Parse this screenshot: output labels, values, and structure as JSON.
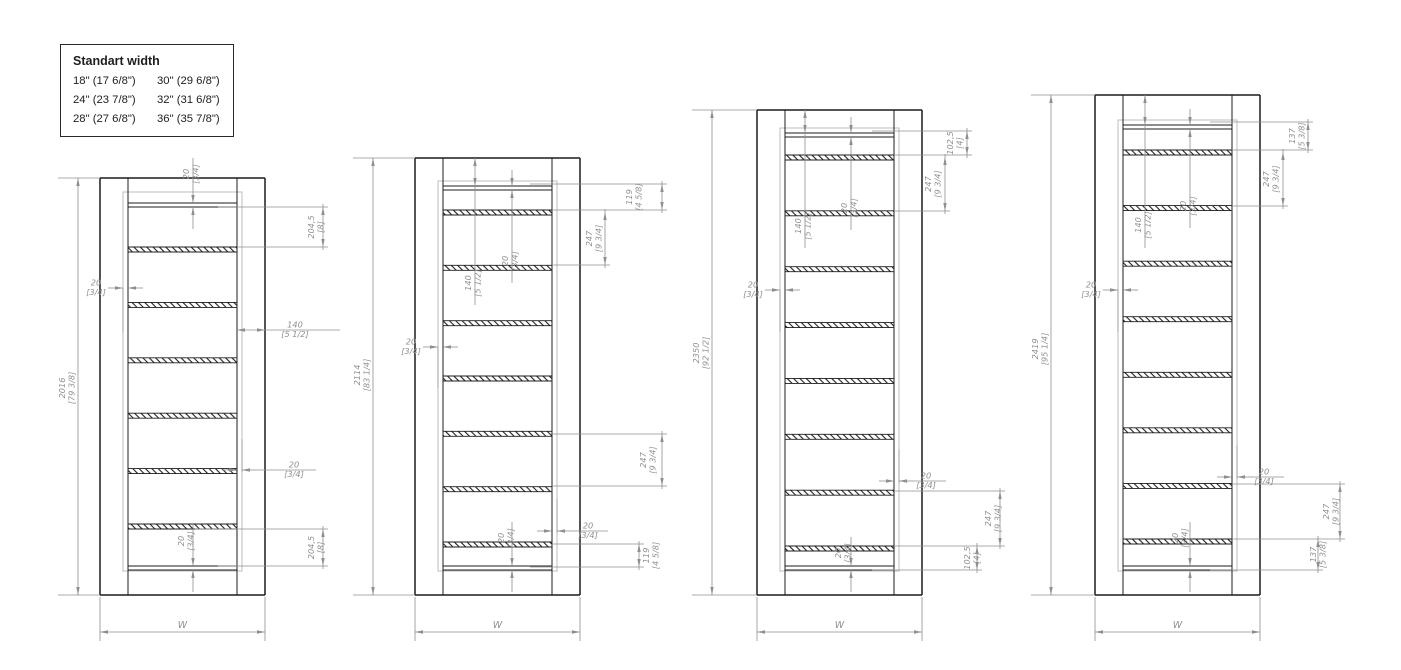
{
  "legend": {
    "title": "Standart width",
    "items": [
      "18\" (17 6/8\")",
      "30\" (29 6/8\")",
      "24\" (23 7/8\")",
      "32\" (31 6/8\")",
      "28\" (27 6/8\")",
      "36\" (35 7/8\")"
    ]
  },
  "styles": {
    "line_color": "#1c1c1c",
    "dim_color": "#8f8f8f",
    "leaf_color": "#bcbcbc",
    "bg": "#ffffff"
  },
  "shared": {
    "width_label": "W",
    "frame_w": 165,
    "jamb_w": 28,
    "bottom_y": 595,
    "bottom_rail_y": 566,
    "leaf_bottom_y": 571,
    "wdim_y": 632,
    "rail_t": 4,
    "shelf_t": 5,
    "leaf_off": 5
  },
  "drawings": [
    {
      "x0": 100,
      "top_y": 178,
      "dim_x": 78,
      "overall_label_y": 388,
      "height_mm": "2016",
      "height_in": "[79 3/8]",
      "rail_y": 203,
      "leaf_top": 192,
      "shelf_first_y": 247,
      "shelf_last_y": 524,
      "shelf_count": 6,
      "annotations": [
        {
          "t": "vrail",
          "x": 193,
          "ya": 203,
          "yb": 207,
          "v": "20",
          "i": "[3/4]",
          "ly": 174,
          "dx": -4
        },
        {
          "t": "bracket",
          "x": 323,
          "ya": 207,
          "yb": 247,
          "v": "204,5",
          "i": "[8]",
          "dx": -9,
          "leaders": [
            [
              218,
              207
            ],
            [
              237,
              247
            ]
          ]
        },
        {
          "t": "hdim",
          "y": 288,
          "xa": 123,
          "xb": 128,
          "arrows": "out",
          "lx": 96,
          "v": "20",
          "i": "[3/4]",
          "ext": [
            [
              123,
              288,
              332
            ]
          ]
        },
        {
          "t": "hdim",
          "y": 330,
          "xa": 237,
          "xb": 265,
          "arrows": "in",
          "lx": 295,
          "tail": 340,
          "v": "140",
          "i": "[5 1/2]"
        },
        {
          "t": "hdim",
          "y": 470,
          "xa": 237,
          "xb": 242,
          "arrows": "out",
          "lx": 294,
          "tail": 316,
          "v": "20",
          "i": "[3/4]",
          "ext": [
            [
              242,
              439,
              472
            ]
          ]
        },
        {
          "t": "bracket",
          "x": 323,
          "ya": 529,
          "yb": 566,
          "v": "204,5",
          "i": "[8]",
          "dx": -9,
          "leaders": [
            [
              195,
              529
            ],
            [
              218,
              566
            ]
          ]
        },
        {
          "t": "vrail",
          "x": 193,
          "ya": 566,
          "yb": 570,
          "v": "20",
          "i": "[3/4]",
          "ly": 541,
          "dx": -9
        }
      ]
    },
    {
      "x0": 415,
      "top_y": 158,
      "dim_x": 373,
      "overall_label_y": 375,
      "height_mm": "2114",
      "height_in": "[83 1/4]",
      "rail_y": 186,
      "leaf_top": 181,
      "shelf_first_y": 210,
      "shelf_last_y": 542,
      "shelf_count": 7,
      "annotations": [
        {
          "t": "innerv",
          "x": 475,
          "ytop": 158,
          "yarr2": 186,
          "yend": 305,
          "ly": 283,
          "dx": -4,
          "v": "140",
          "i": "[5 1/2]"
        },
        {
          "t": "innerv20",
          "x": 512,
          "ya": 186,
          "yb": 190,
          "yend": 283,
          "ly": 261,
          "dx": -4,
          "v": "20",
          "i": "[3/4]"
        },
        {
          "t": "bracket",
          "x": 662,
          "ya": 184,
          "yb": 210,
          "v": "119",
          "i": "[4 5/8]",
          "dx": -30,
          "leaders": [
            [
              530,
              184
            ],
            [
              552,
              210
            ]
          ]
        },
        {
          "t": "bracket",
          "x": 605,
          "ya": 212,
          "yb": 265,
          "v": "247",
          "i": "[9 3/4]",
          "dx": -13,
          "leaders": [
            [
              552,
              265
            ]
          ]
        },
        {
          "t": "hdim",
          "y": 347,
          "xa": 438,
          "xb": 443,
          "arrows": "out",
          "lx": 411,
          "v": "20",
          "i": "[3/4]",
          "ext": [
            [
              438,
              347,
              388
            ]
          ]
        },
        {
          "t": "bracket",
          "x": 662,
          "ya": 434,
          "yb": 486,
          "v": "247",
          "i": "[9 3/4]",
          "dx": -16,
          "leaders": [
            [
              552,
              434
            ],
            [
              552,
              486
            ]
          ]
        },
        {
          "t": "hdim",
          "y": 531,
          "xa": 552,
          "xb": 557,
          "arrows": "out",
          "lx": 588,
          "tail": 608,
          "v": "20",
          "i": "[3/4]",
          "ext": [
            [
              557,
              499,
              533
            ]
          ]
        },
        {
          "t": "bracket",
          "x": 639,
          "ya": 544,
          "yb": 567,
          "v": "119",
          "i": "[4 5/8]",
          "dx": 10,
          "leaders": [
            [
              552,
              544
            ],
            [
              530,
              567
            ]
          ]
        },
        {
          "t": "vrail",
          "x": 512,
          "ya": 566,
          "yb": 570,
          "v": "20",
          "i": "[3/4]",
          "ly": 538,
          "dx": -8
        }
      ]
    },
    {
      "x0": 757,
      "top_y": 110,
      "dim_x": 712,
      "overall_label_y": 353,
      "height_mm": "2350",
      "height_in": "[92 1/2]",
      "rail_y": 133,
      "leaf_top": 128,
      "shelf_first_y": 155,
      "shelf_last_y": 546,
      "shelf_count": 8,
      "annotations": [
        {
          "t": "innerv",
          "x": 805,
          "ytop": 110,
          "yarr2": 133,
          "yend": 248,
          "ly": 226,
          "dx": -4,
          "v": "140",
          "i": "[5 1/2]"
        },
        {
          "t": "innerv20",
          "x": 851,
          "ya": 133,
          "yb": 137,
          "yend": 230,
          "ly": 208,
          "dx": -4,
          "v": "20",
          "i": "[3/4]"
        },
        {
          "t": "bracket",
          "x": 967,
          "ya": 131,
          "yb": 155,
          "v": "102,5",
          "i": "[4]",
          "dx": -14,
          "leaders": [
            [
              872,
              131
            ],
            [
              894,
              155
            ]
          ]
        },
        {
          "t": "bracket",
          "x": 945,
          "ya": 157,
          "yb": 211,
          "v": "247",
          "i": "[9 3/4]",
          "dx": -14,
          "leaders": [
            [
              894,
              211
            ]
          ]
        },
        {
          "t": "hdim",
          "y": 290,
          "xa": 780,
          "xb": 785,
          "arrows": "out",
          "lx": 753,
          "v": "20",
          "i": "[3/4]",
          "ext": [
            [
              780,
              290,
              332
            ]
          ]
        },
        {
          "t": "hdim",
          "y": 481,
          "xa": 894,
          "xb": 899,
          "arrows": "out",
          "lx": 926,
          "tail": 946,
          "v": "20",
          "i": "[3/4]",
          "ext": [
            [
              899,
              449,
              483
            ]
          ]
        },
        {
          "t": "bracket",
          "x": 1000,
          "ya": 491,
          "yb": 546,
          "v": "247",
          "i": "[9 3/4]",
          "dx": -9,
          "leaders": [
            [
              894,
              491
            ],
            [
              894,
              546
            ]
          ]
        },
        {
          "t": "bracket",
          "x": 977,
          "ya": 546,
          "yb": 570,
          "v": "102,5",
          "i": "[4]",
          "dx": -7,
          "leaders": [
            [
              872,
              570
            ]
          ]
        },
        {
          "t": "vrail",
          "x": 851,
          "ya": 566,
          "yb": 570,
          "v": "20",
          "i": "[3/4]",
          "ly": 553,
          "dx": -10
        }
      ]
    },
    {
      "x0": 1095,
      "top_y": 95,
      "dim_x": 1051,
      "overall_label_y": 349,
      "height_mm": "2419",
      "height_in": "[95 1/4]",
      "rail_y": 125,
      "leaf_top": 120,
      "shelf_first_y": 150,
      "shelf_last_y": 539,
      "shelf_count": 8,
      "annotations": [
        {
          "t": "innerv",
          "x": 1145,
          "ytop": 95,
          "yarr2": 125,
          "yend": 248,
          "ly": 225,
          "dx": -4,
          "v": "140",
          "i": "[5 1/2]"
        },
        {
          "t": "innerv20",
          "x": 1190,
          "ya": 125,
          "yb": 129,
          "yend": 228,
          "ly": 206,
          "dx": -4,
          "v": "20",
          "i": "[3/4]"
        },
        {
          "t": "bracket",
          "x": 1308,
          "ya": 122,
          "yb": 150,
          "v": "137",
          "i": "[5 3/8]",
          "dx": -13,
          "leaders": [
            [
              1210,
              122
            ],
            [
              1232,
              150
            ]
          ]
        },
        {
          "t": "bracket",
          "x": 1283,
          "ya": 152,
          "yb": 206,
          "v": "247",
          "i": "[9 3/4]",
          "dx": -14,
          "leaders": [
            [
              1232,
              206
            ]
          ]
        },
        {
          "t": "hdim",
          "y": 290,
          "xa": 1118,
          "xb": 1123,
          "arrows": "out",
          "lx": 1091,
          "v": "20",
          "i": "[3/4]",
          "ext": [
            [
              1118,
              290,
              332
            ]
          ]
        },
        {
          "t": "hdim",
          "y": 477,
          "xa": 1232,
          "xb": 1237,
          "arrows": "out",
          "lx": 1264,
          "tail": 1284,
          "v": "20",
          "i": "[3/4]",
          "ext": [
            [
              1237,
              445,
              479
            ]
          ]
        },
        {
          "t": "bracket",
          "x": 1340,
          "ya": 484,
          "yb": 539,
          "v": "247",
          "i": "[9 3/4]",
          "dx": -11,
          "leaders": [
            [
              1232,
              484
            ],
            [
              1232,
              539
            ]
          ]
        },
        {
          "t": "bracket",
          "x": 1318,
          "ya": 539,
          "yb": 570,
          "v": "137",
          "i": "[5 3/8]",
          "dx": -2,
          "leaders": [
            [
              1210,
              570
            ]
          ]
        },
        {
          "t": "vrail",
          "x": 1190,
          "ya": 566,
          "yb": 570,
          "v": "20",
          "i": "[3/4]",
          "ly": 538,
          "dx": -12
        }
      ]
    }
  ]
}
